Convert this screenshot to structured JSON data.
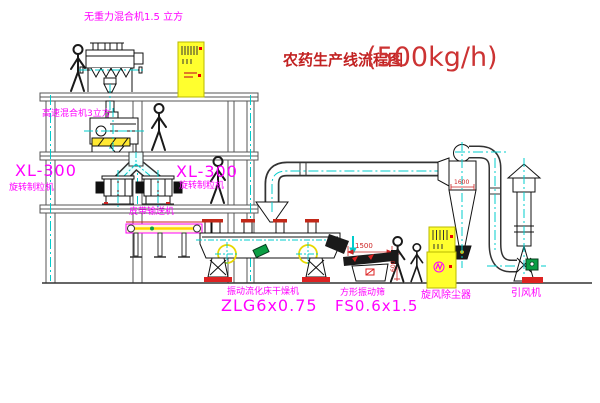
{
  "title": {
    "name": "农药生产线流程图",
    "capacity": "(500kg/h)"
  },
  "labels": {
    "gravity_mixer": "无重力混合机1.5 立方",
    "high_speed_mixer": "高速混合机3立方",
    "granulator_left_model": "XL-300",
    "granulator_left_name": "旋转制粒机",
    "granulator_right_model": "XL-300",
    "granulator_right_name": "旋转制粒机",
    "belt_conveyor": "皮带输送机",
    "dryer_name": "振动流化床干燥机",
    "dryer_model": "ZLG6x0.75",
    "sieve_name": "方形振动筛",
    "sieve_model": "FS0.6x1.5",
    "cyclone": "旋风除尘器",
    "fan": "引风机"
  },
  "dimensions": {
    "sieve_length": "1500",
    "sieve_height": "600",
    "cyclone": "1600"
  },
  "colors": {
    "line": "#1a1a1a",
    "structure": "#555555",
    "centerline": "#00CCCC",
    "label_magenta": "#FF00FF",
    "title_red": "#CC2222",
    "cabinet_yellow": "#FFFF2E",
    "alert_red": "#DD2222",
    "motor_green": "#0B9E44",
    "vibrator_yellow": "#E8D800"
  }
}
